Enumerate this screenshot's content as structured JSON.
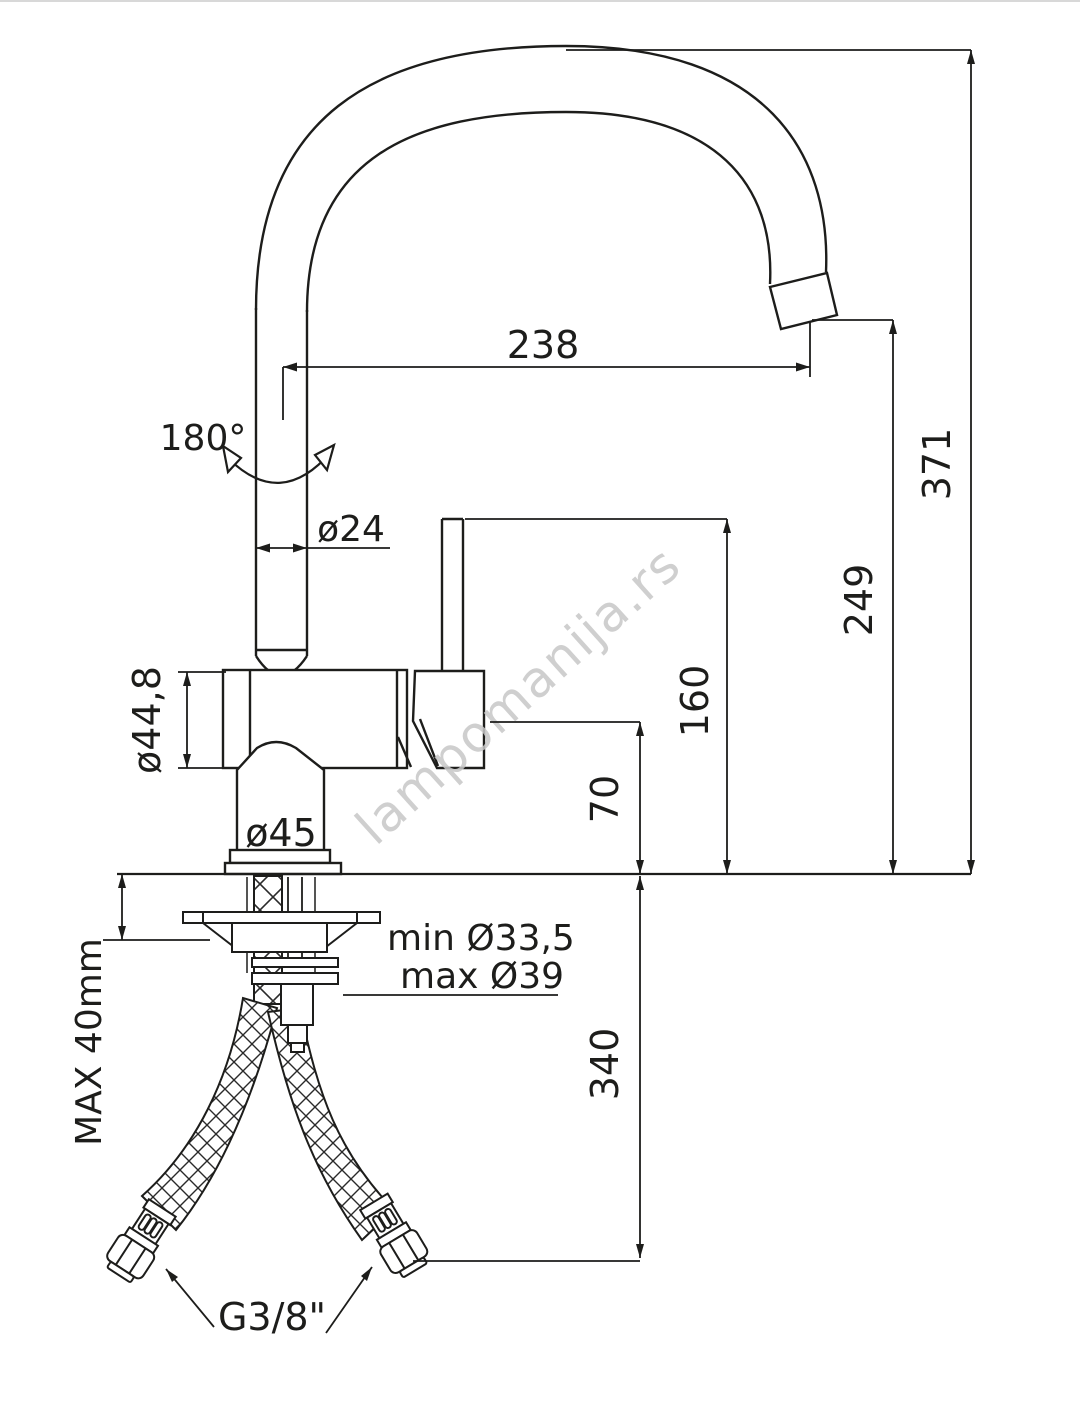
{
  "drawing": {
    "type": "technical-dimension-diagram",
    "subject": "single-lever kitchen sink mixer tap with high swivel C-spout and flexible supply hoses",
    "labels": {
      "swivel_angle": "180°",
      "spout_reach": "238",
      "overall_height": "371",
      "outlet_height": "249",
      "handle_height": "160",
      "body_height": "70",
      "hose_drop": "340",
      "tube_diameter": "ø24",
      "body_diameter": "ø44,8",
      "base_diameter": "ø45",
      "hole_min": "min Ø33,5",
      "hole_max": "max Ø39",
      "counter_max_thickness": "MAX 40mm",
      "hose_thread": "G3/8\""
    },
    "watermark": "lampomanija.rs",
    "colors": {
      "line": "#1d1d1b",
      "watermark": "#c7c7c7",
      "background": "#ffffff",
      "top_border": "#d8d8d8"
    }
  }
}
